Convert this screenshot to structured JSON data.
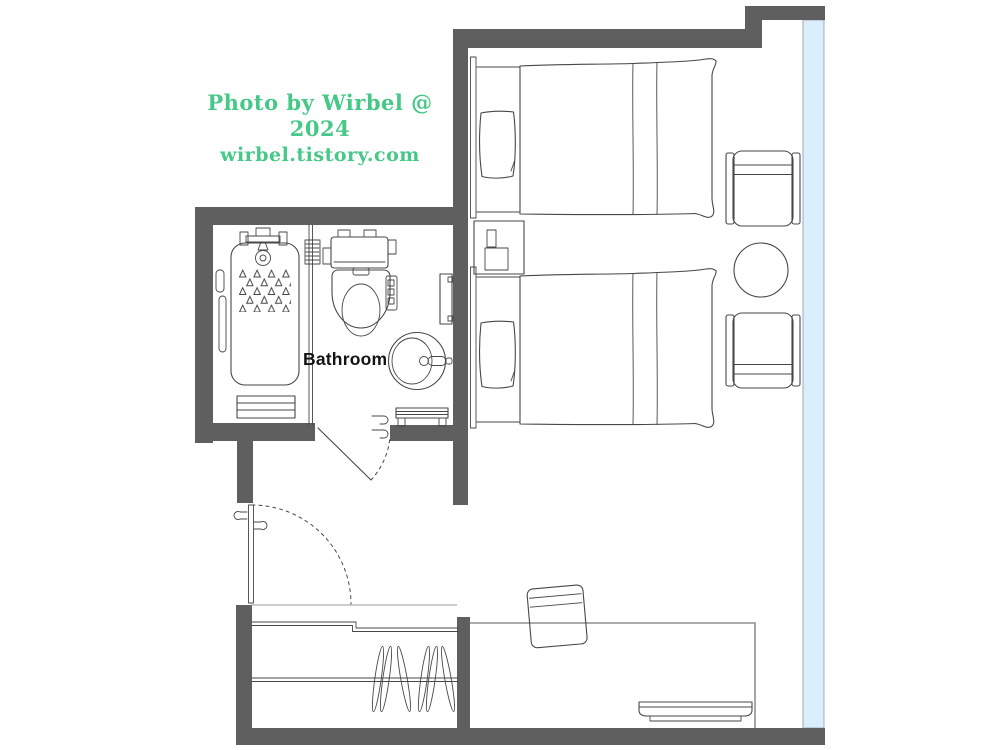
{
  "watermark": {
    "line1": "Photo by Wirbel @ 2024",
    "line2": "wirbel.tistory.com"
  },
  "labels": {
    "bathroom": "Bathroom"
  },
  "colors": {
    "wall": "#5F5F5F",
    "window": "#DCEDFB",
    "line": "#474747",
    "desk-line": "#8F8F8F",
    "watermark": "#46C887",
    "label": "#141414"
  },
  "furniture_icons": [
    "twin-bed-upper",
    "twin-bed-lower",
    "pillow",
    "nightstand",
    "phone",
    "lamp",
    "armchair-upper",
    "armchair-lower",
    "round-table",
    "bathtub",
    "shower-head",
    "anti-slip-pattern",
    "bath-step",
    "grab-bar",
    "toilet-bidet",
    "washbasin",
    "towel-rack",
    "bath-bench",
    "vent-grille",
    "glass-partition",
    "bathroom-door",
    "entry-door",
    "closet-shelf",
    "closet-rod",
    "clothes-hangers",
    "desk",
    "desk-chair",
    "tv",
    "window-wall"
  ]
}
